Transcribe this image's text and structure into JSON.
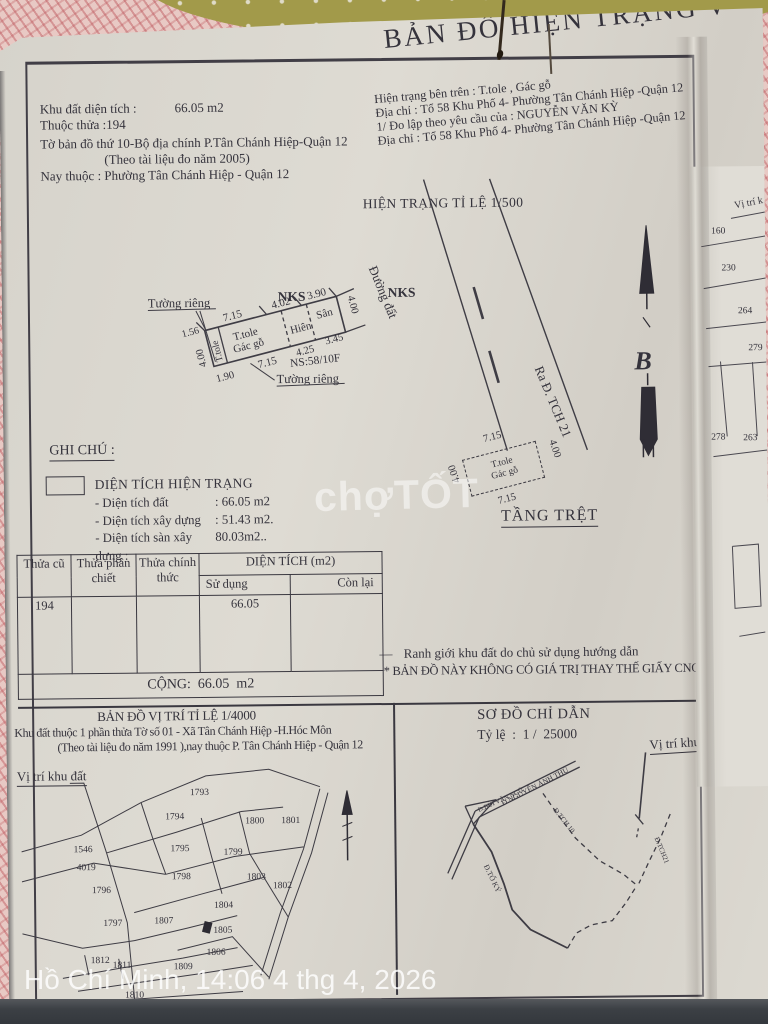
{
  "document": {
    "title": "BẢN ĐỒ HIỆN TRẠNG V",
    "info_left": {
      "area_label": "Khu đất diện tích :",
      "area_value": "66.05 m2",
      "parcel_line": "Thuộc thửa :194",
      "map_sheet_line": "Tờ bản đồ thứ 10-Bộ địa chính P.Tân Chánh Hiệp-Quận 12",
      "survey_year_line": "(Theo tài liệu đo năm 2005)",
      "now_belongs_line": "Nay thuộc :  Phường Tân Chánh Hiệp - Quận 12"
    },
    "info_right": {
      "status_line": "Hiện trạng bên trên : T.tole , Gác gỗ",
      "address_line1": "Địa chỉ : Tổ 58 Khu Phố 4- Phường Tân Chánh Hiệp -Quận 12",
      "request_line": "1/ Đo lập theo yêu cầu của : NGUYỄN VĂN KỲ",
      "address_line2": "Địa chỉ : Tổ 58 Khu Phố 4- Phường Tân Chánh Hiệp -Quận 12"
    }
  },
  "survey": {
    "title": "HIỆN TRẠNG TỈ LỆ 1/500",
    "wall_top": "Tường riêng",
    "wall_bottom": "Tường riêng",
    "nks_left": "NKS",
    "nks_right": "NKS",
    "house_no": "NS:58/10F",
    "road_name": "Đường đất",
    "road_out": "Ra Đ. TCH 21",
    "north": "B",
    "plot": {
      "mat1": "T.tole",
      "mat2": "Gác gỗ",
      "side_mat": "T.tole",
      "porch": "Hiên",
      "yard": "Sân",
      "d_top1": "7.15",
      "d_top2": "4.02",
      "d_top3": "3.90",
      "d_corner": "1.56",
      "d_left": "4.00",
      "d_right": "4.00",
      "d_bot1": "1.90",
      "d_bot2": "7.15",
      "d_bot3": "4.25",
      "d_bot4": "3.45"
    }
  },
  "ghi_chu": {
    "title": "GHI CHÚ :",
    "legend_title": "DIỆN TÍCH HIỆN TRẠNG",
    "items": [
      {
        "label": "- Diện tích đất",
        "value": ":  66.05 m2"
      },
      {
        "label": "- Diện tích xây dựng",
        "value": ":  51.43 m2."
      },
      {
        "label": "- Diện tích sàn xây dựng :",
        "value": "80.03m2.."
      }
    ]
  },
  "ground_floor": {
    "title": "TẦNG TRỆT",
    "mat1": "T.tole",
    "mat2": "Gác gỗ",
    "d_top": "7.15",
    "d_bottom": "7.15",
    "d_left": "4.00",
    "d_right": "4.00"
  },
  "area_table": {
    "col_old": "Thửa cũ",
    "col_split": "Thửa phân chiết",
    "col_official": "Thửa chính thức",
    "col_area": "DIỆN TÍCH (m2)",
    "col_used": "Sử dụng",
    "col_remain": "Còn lại",
    "row": {
      "old": "194",
      "split": "",
      "official": "",
      "used": "66.05",
      "remain": ""
    },
    "total": "CỘNG:  66.05  m2"
  },
  "notes": {
    "boundary_marker": "—",
    "boundary_note": "Ranh giới khu đất do chủ sử dụng hướng dẫn",
    "validity_note": "* BẢN ĐỒ NÀY KHÔNG CÓ GIÁ TRỊ THAY THẾ GIẤY CNQSDĐ"
  },
  "location_map": {
    "title": "BẢN ĐỒ VỊ TRÍ TỈ LỆ 1/4000",
    "desc1": "Khu đất thuộc 1 phần thửa Tờ số 01 - Xã Tân Chánh Hiệp -H.Hóc Môn",
    "desc2": "(Theo tài liệu đo năm 1991 ),nay thuộc P. Tân Chánh Hiệp - Quận 12",
    "location_label": "Vị trí khu đất",
    "parcels": [
      "1793",
      "1794",
      "1795",
      "1796",
      "1797",
      "1798",
      "1799",
      "1800",
      "1801",
      "1802",
      "1803",
      "1804",
      "1805",
      "1806",
      "1807",
      "1809",
      "1810",
      "1811",
      "1812",
      "1546",
      "4019"
    ]
  },
  "guide_map": {
    "title": "SƠ ĐỒ CHỈ DẪN",
    "scale": "Tỷ lệ  :  1 /  25000",
    "location_label": "Vị trí khu đất",
    "road1": "Đ.BÙI VĂN NGỮ",
    "road2": "Đ.NGUYỄN ẢNH THỦ",
    "road3": "Đ.TCH 10",
    "road4": "Đ.TCH21",
    "road5": "Đ.TỔ KÝ"
  },
  "side_sheet": {
    "label": "Vị trí k",
    "numbers": [
      "160",
      "230",
      "264",
      "279",
      "278",
      "263"
    ]
  },
  "watermarks": {
    "brand": "chợTỐT",
    "timestamp": "Hồ Chí Minh, 14:06 4 thg 4, 2026"
  },
  "colors": {
    "paper": "#dad7cf",
    "ink": "#35333c",
    "background_pink": "#e8c9c4",
    "blanket_olive": "#a29a4a",
    "bottom_strip": "#3c4045",
    "watermark_white": "#ffffff"
  }
}
